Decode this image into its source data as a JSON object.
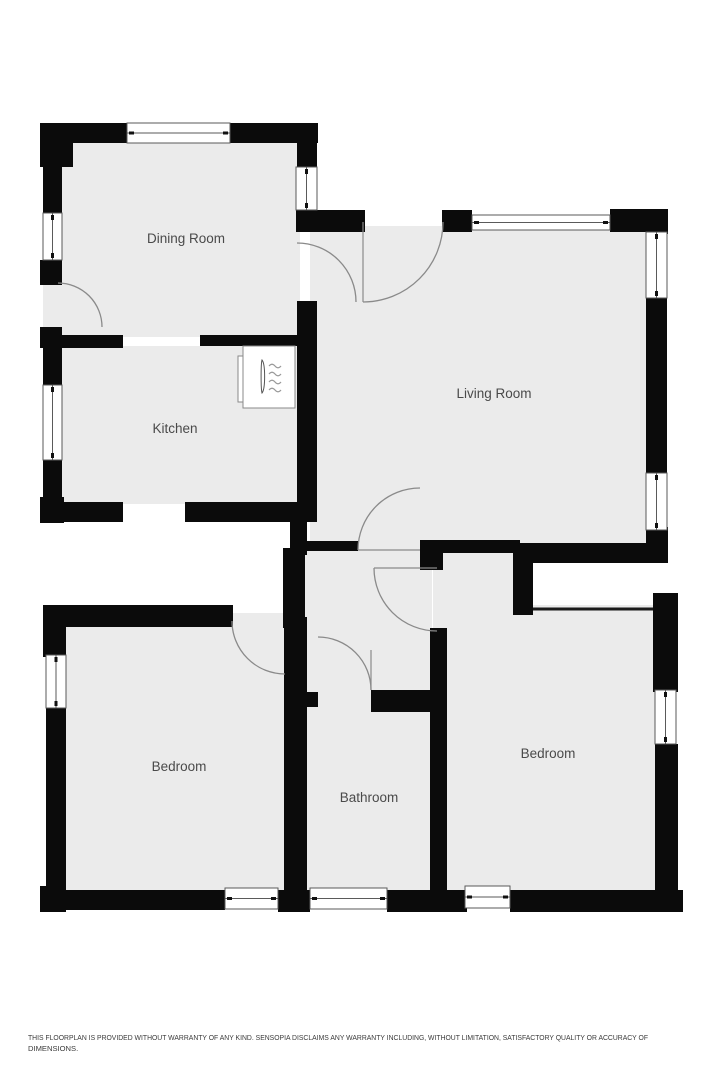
{
  "floorplan": {
    "rooms": [
      {
        "id": "dining-room",
        "label": "Dining Room"
      },
      {
        "id": "kitchen",
        "label": "Kitchen"
      },
      {
        "id": "living-room",
        "label": "Living Room"
      },
      {
        "id": "bedroom-left",
        "label": "Bedroom"
      },
      {
        "id": "bathroom",
        "label": "Bathroom"
      },
      {
        "id": "bedroom-right",
        "label": "Bedroom"
      }
    ],
    "icons": {
      "radiator": "radiator-icon"
    },
    "colors": {
      "wall": "#0b0b0b",
      "floor": "#ebebeb",
      "door_arc": "#8a8a8a",
      "label": "#4a4a4a",
      "background": "#ffffff"
    }
  },
  "disclaimer": {
    "line1": "THIS FLOORPLAN IS PROVIDED WITHOUT WARRANTY OF ANY KIND. SENSOPIA DISCLAIMS ANY WARRANTY INCLUDING, WITHOUT LIMITATION, SATISFACTORY QUALITY OR ACCURACY OF",
    "line2": "DIMENSIONS."
  }
}
